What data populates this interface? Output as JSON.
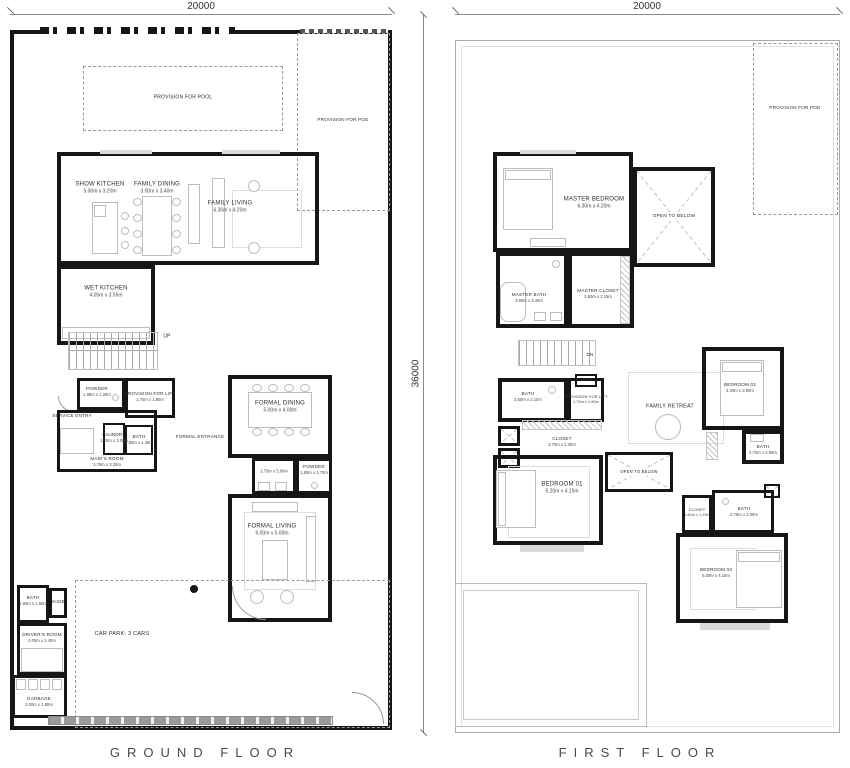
{
  "titles": {
    "ground": "GROUND FLOOR",
    "first": "FIRST FLOOR"
  },
  "dimensions": {
    "ground_width": "20000",
    "first_width": "20000",
    "side_height": "36000"
  },
  "ground": {
    "provision_pool": "PROVISION FOR POOL",
    "provision_pod": "PROVISION FOR POD",
    "show_kitchen": {
      "label": "SHOW KITCHEN",
      "dims": "5.00m x 3.20m"
    },
    "family_dining": {
      "label": "FAMILY DINING",
      "dims": "3.00m x 3.40m"
    },
    "family_living": {
      "label": "FAMILY LIVING",
      "dims": "6.30m x 4.20m"
    },
    "wet_kitchen": {
      "label": "WET KITCHEN",
      "dims": "4.05m x 3.55m"
    },
    "stairs_up": "UP",
    "powder_1": {
      "label": "POWDER",
      "dims": "1.98m x 1.20m"
    },
    "provision_lift": {
      "label": "PROVISION FOR LIFT",
      "dims": "1.75m x 1.90m"
    },
    "service_entry": "SERVICE ENTRY",
    "laundry": {
      "label": "LAUNDRY",
      "dims": "1.20m x 3.00m"
    },
    "bath_maids": {
      "label": "BATH",
      "dims": "1.55m x 1.45m"
    },
    "maids_room": {
      "label": "MAID'S ROOM",
      "dims": "3.75m x 3.20m"
    },
    "formal_entrance": "FORMAL ENTRANCE",
    "formal_dining": {
      "label": "FORMAL DINING",
      "dims": "5.00m x 4.00m"
    },
    "pantry_dims": "1.75m x 5.00m",
    "powder_2": {
      "label": "POWDER",
      "dims": "1.80m x 1.70m"
    },
    "formal_living": {
      "label": "FORMAL LIVING",
      "dims": "6.00m x 5.00m"
    },
    "bath_service": {
      "label": "BATH",
      "dims": "1.90m x 1.60m"
    },
    "shoe": "SHOE",
    "drivers_room": {
      "label": "DRIVER'S ROOM",
      "dims": "2.00m x 2.40m"
    },
    "garbage": {
      "label": "GARBAGE",
      "dims": "2.00m x 1.60m"
    },
    "car_park": "CAR PARK: 3 CARS"
  },
  "first": {
    "provision_pod": "PROVISION FOR POD",
    "master_bedroom": {
      "label": "MASTER BEDROOM",
      "dims": "6.30m x 4.20m"
    },
    "open_to_below_1": "OPEN TO BELOW",
    "master_bath": {
      "label": "MASTER BATH",
      "dims": "3.80m x 3.40m"
    },
    "master_closet": {
      "label": "MASTER CLOSET",
      "dims": "2.80m x 2.15m"
    },
    "stairs_dn": "DN",
    "acp": "ACP",
    "bath_1": {
      "label": "BATH",
      "dims": "3.50m x 2.10m"
    },
    "provision_lift": {
      "label": "PROVISION FOR LIFT",
      "dims": "1.75m x 1.80m"
    },
    "closet_1": {
      "label": "CLOSET",
      "dims": "3.70m x 1.30m"
    },
    "family_retreat": "FAMILY RETREAT",
    "open_to_below_2": "OPEN TO BELOW",
    "bedroom_1": {
      "label": "BEDROOM 01",
      "dims": "5.20m x 4.15m"
    },
    "bedroom_2": {
      "label": "BEDROOM 02",
      "dims": "4.00m x 3.90m"
    },
    "bath_2": {
      "label": "BATH",
      "dims": "2.70m x 2.90m"
    },
    "closet_2": {
      "label": "CLOSET",
      "dims": "1.80m x 1.25m"
    },
    "bath_3": {
      "label": "BATH",
      "dims": "2.75m x 2.00m"
    },
    "bedroom_3": {
      "label": "BEDROOM 03",
      "dims": "5.00m x 4.10m"
    }
  }
}
